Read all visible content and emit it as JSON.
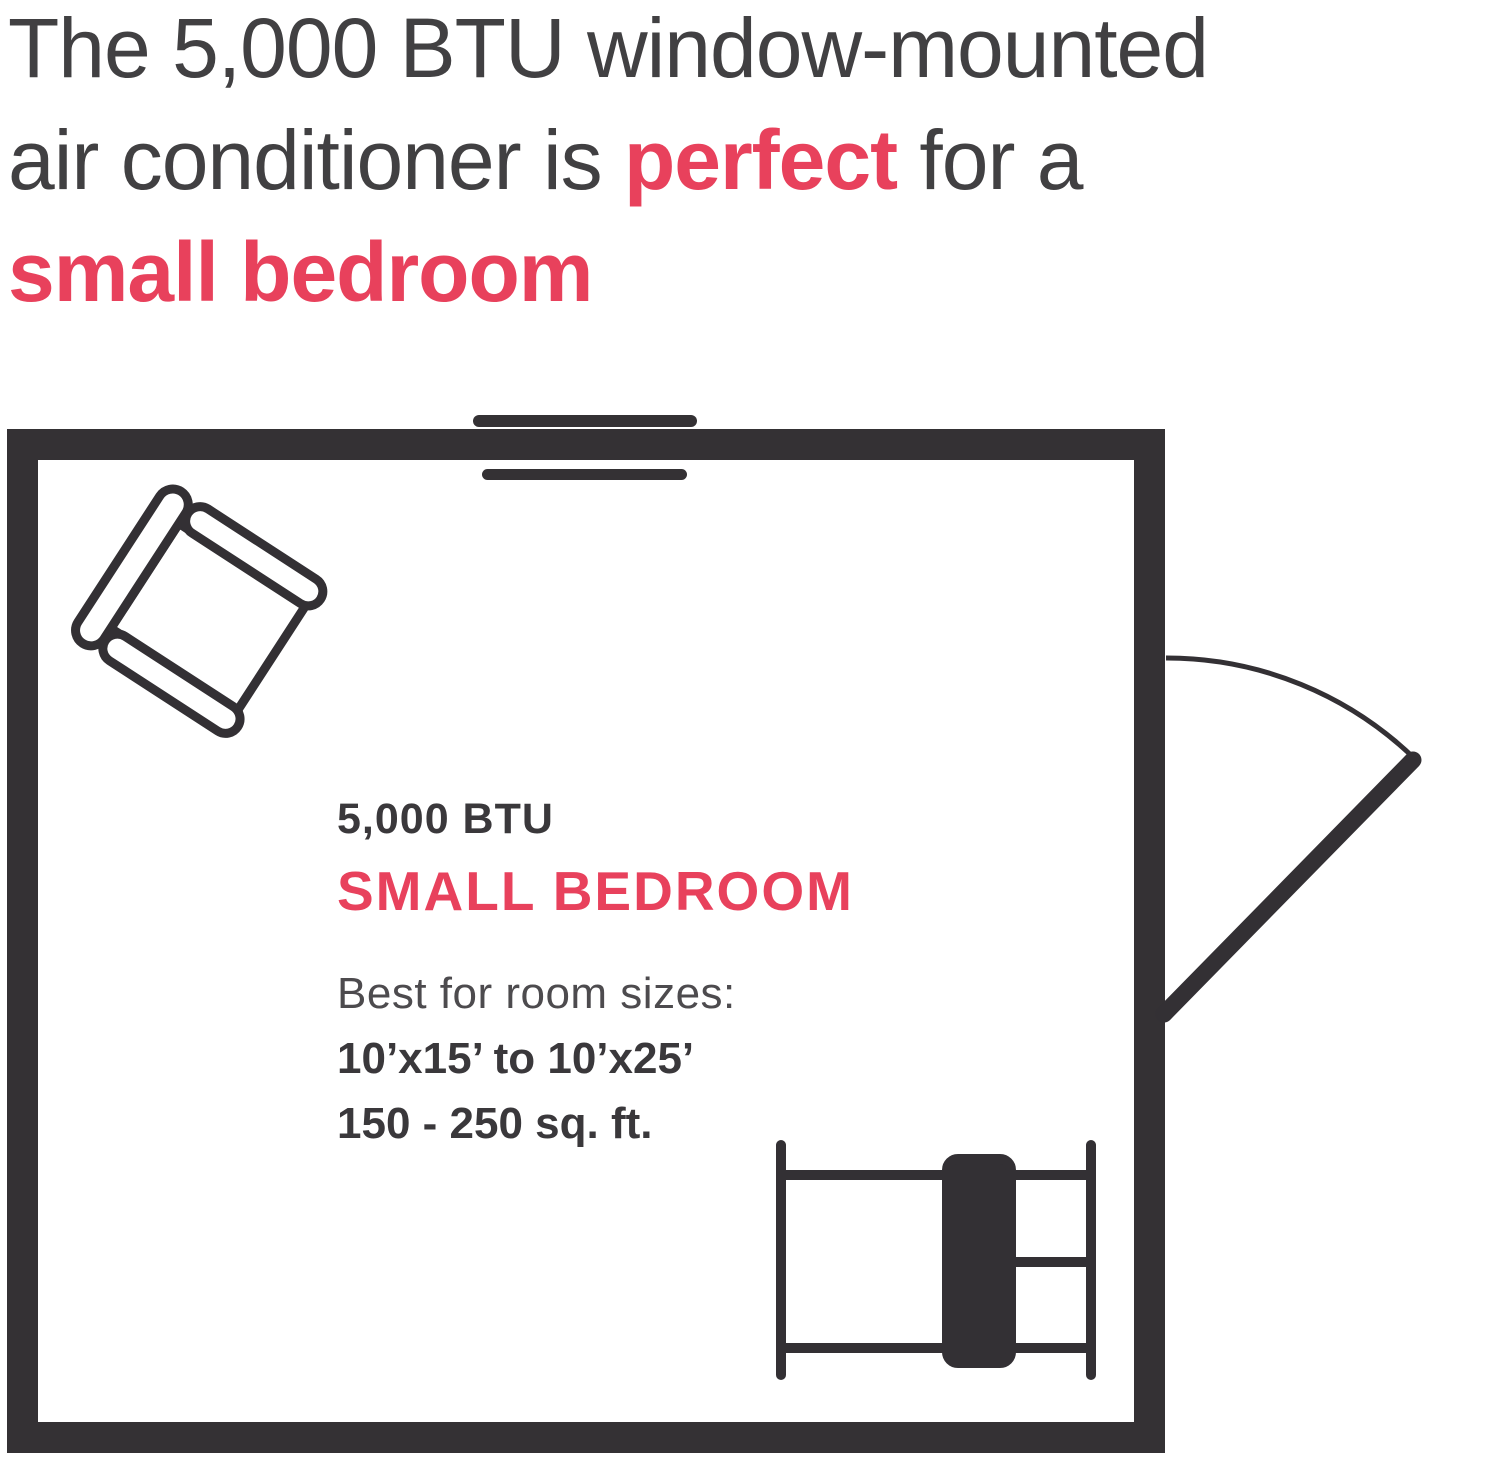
{
  "headline": {
    "line1": "The 5,000 BTU window-mounted",
    "line2_pre": "air conditioner is ",
    "line2_accent": "perfect",
    "line2_post": " for a",
    "line3_accent": "small bedroom"
  },
  "floor_plan": {
    "btu_label": "5,000 BTU",
    "room_label": "SMALL BEDROOM",
    "best_label": "Best for room sizes:",
    "dims_label": "10’x15’ to 10’x25’",
    "area_label": "150 - 250 sq. ft.",
    "icons": [
      "window-ac-icon",
      "armchair-icon",
      "door-icon",
      "bed-icon"
    ]
  },
  "colors": {
    "accent_red": "#e8415c",
    "wall_dark": "#343134",
    "text_dark": "#3a383b",
    "text_gray": "#4d4b4e",
    "background": "#ffffff"
  }
}
